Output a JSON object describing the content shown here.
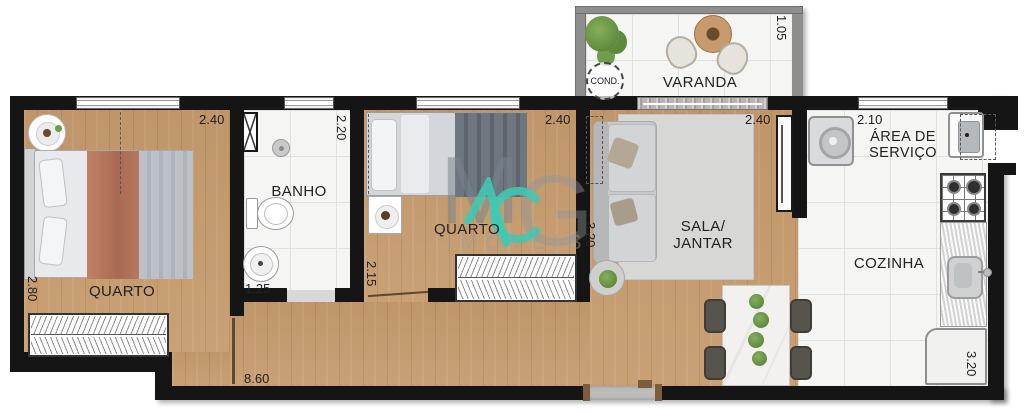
{
  "plan": {
    "varanda": {
      "label": "VARANDA",
      "dim": "1.05",
      "cond": "COND."
    },
    "quarto1": {
      "label": "QUARTO",
      "dim_w": "2.40",
      "dim_h": "2.80"
    },
    "banho": {
      "label": "BANHO",
      "dim_h": "2.20",
      "dim_w": "1.25"
    },
    "quarto2": {
      "label": "QUARTO",
      "dim_w": "2.40",
      "dim_h": "2.15"
    },
    "sala": {
      "label1": "SALA/",
      "label2": "JANTAR",
      "dim_w": "2.40",
      "dim_h": "3.20"
    },
    "servico": {
      "label1": "ÁREA DE",
      "label2": "SERVIÇO",
      "dim": "2.10"
    },
    "cozinha": {
      "label": "COZINHA",
      "dim": "3.20"
    },
    "total_width_dim": "8.60",
    "watermark": {
      "m": "M",
      "g": "G",
      "word": "IMÓVEIS"
    }
  },
  "colors": {
    "wall": "#151515",
    "wood": "#c79b6e",
    "tile": "#f5f5f3",
    "tile_line": "#e0e0de",
    "varanda_wall": "#8e8e8e",
    "teal": "#3ec9b4",
    "watermark": "#8b97a1",
    "text": "#222220"
  }
}
